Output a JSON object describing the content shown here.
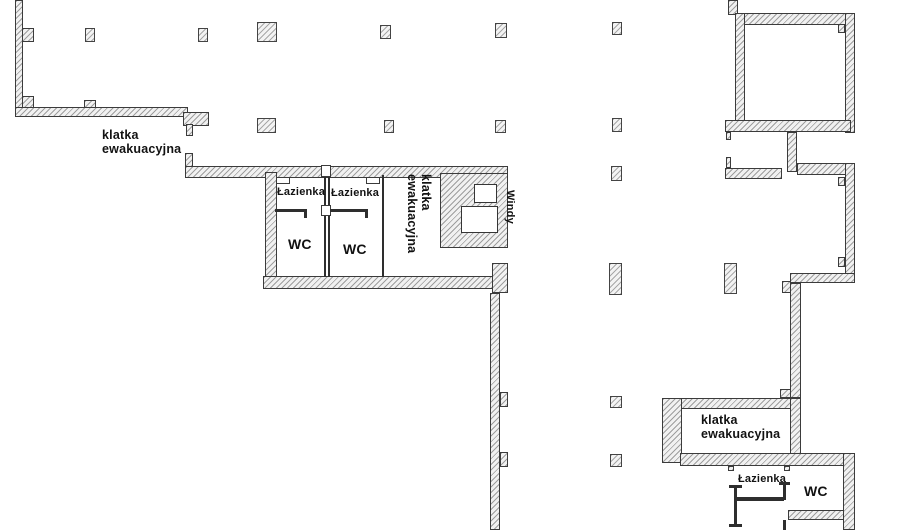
{
  "document": {
    "type": "architectural floor plan",
    "language": "Polish"
  },
  "colors": {
    "background": "#ffffff",
    "wall_fill": "#f1f1f1",
    "wall_hatch": "#9e9e9e",
    "wall_outline": "#3b3b3b",
    "partition": "#2e2e2e",
    "label_text": "#121212"
  },
  "labels": {
    "stair_top_left": {
      "line1": "klatka",
      "line2": "ewakuacyjna"
    },
    "stair_middle": {
      "line1": "klatka",
      "line2": "ewakuacyjna"
    },
    "stair_right": {
      "line1": "klatka",
      "line2": "ewakuacyjna"
    },
    "bathroom_left": "Łazienka",
    "bathroom_middle": "Łazienka",
    "bathroom_bottom_right": "Łazienka",
    "wc_left": "WC",
    "wc_middle": "WC",
    "wc_bottom_right": "WC",
    "elevators": "Windy"
  }
}
